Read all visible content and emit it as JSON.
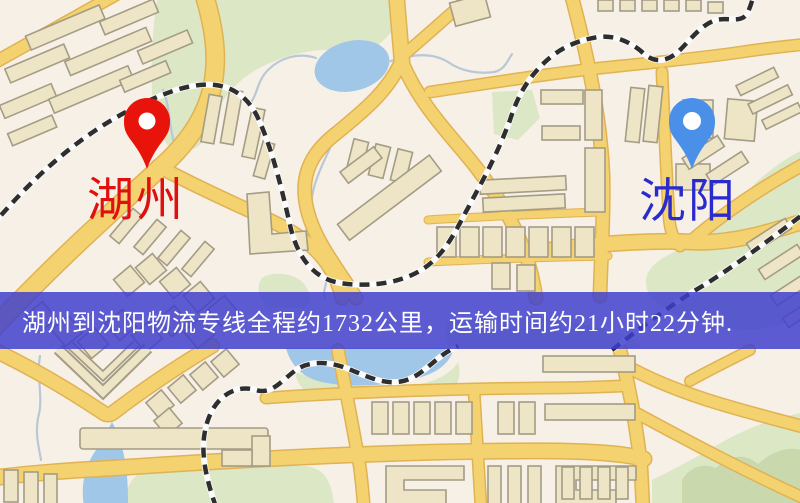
{
  "map": {
    "origin": {
      "label": "湖州"
    },
    "destination": {
      "label": "沈阳"
    },
    "banner": {
      "text": "湖州到沈阳物流专线全程约1732公里，运输时间约21小时22分钟.",
      "distance_km": "1732",
      "duration": "21小时22分钟"
    }
  },
  "icons": {
    "origin_pin": "red-map-pin-icon",
    "destination_pin": "blue-map-pin-icon"
  },
  "colors": {
    "background": "#f7f0e7",
    "road": "#f4d26f",
    "road_casing": "#e0b254",
    "park": "#dbe7c5",
    "park_dark": "#c9d9ad",
    "water": "#a0c6e8",
    "stream": "#b8c8d6",
    "building": "#eee4c6",
    "building_outline": "#a49c84",
    "railway": "#2e2e2e",
    "railway_bed": "#fbfbfb",
    "banner_bg": "rgba(62,62,206,0.84)",
    "banner_text": "#ffffff",
    "origin_pin": "#e8140c",
    "destination_pin": "#4a90e8",
    "pin_hole": "#ffffff",
    "origin_label": "#e01010",
    "destination_label": "#2a2acf"
  }
}
